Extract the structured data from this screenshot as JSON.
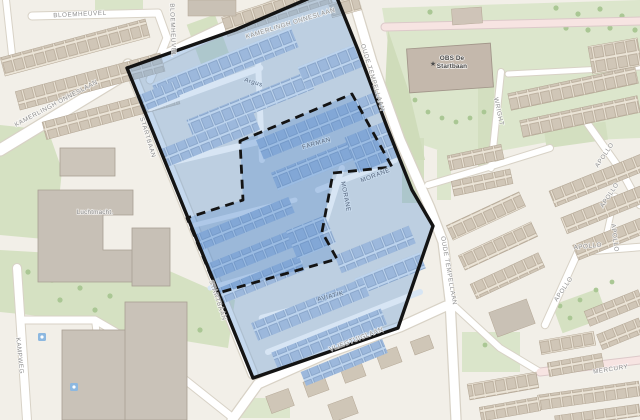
{
  "map": {
    "street_labels": [
      {
        "text": "BLOEMHEUVEL"
      },
      {
        "text": "BLOEMHEUVEL"
      },
      {
        "text": "KAMERLINGH ONNESLAAN"
      },
      {
        "text": "KAMERLINGH ONNESLAAN"
      },
      {
        "text": "OUDE TEMPELLAAN"
      },
      {
        "text": "OUDE TEMPELLAAN"
      },
      {
        "text": "STARTBAAN"
      },
      {
        "text": "STARTBAAN"
      },
      {
        "text": "VLIEGTUIGLAAN"
      },
      {
        "text": "KAMPWEG"
      },
      {
        "text": "WRIGHT"
      },
      {
        "text": "APOLLO"
      },
      {
        "text": "APOLLO"
      },
      {
        "text": "APOLLO"
      },
      {
        "text": "APOLLO"
      },
      {
        "text": "APOLLO"
      },
      {
        "text": "MERCURY"
      },
      {
        "text": "FARMAN"
      },
      {
        "text": "MORANE"
      },
      {
        "text": "MORANE"
      },
      {
        "text": "AVIATIK"
      },
      {
        "text": "Argus"
      }
    ],
    "poi": {
      "school_line1": "OBS De",
      "school_line2": "Startbaan",
      "building_label": "Luchtmacht."
    },
    "overlay": {
      "outer_fill": "#7da9dc",
      "inner_fill": "#3a78c4",
      "border_color": "#141414",
      "border_style_outer": "solid",
      "border_style_inner": "dashed"
    },
    "icon_names": [
      "school-icon",
      "poi-marker-icon",
      "poi-marker-icon"
    ],
    "base_colors": {
      "background": "#f2efe8",
      "green": "#d9e4c8",
      "road": "#ffffff",
      "road_pink": "#f7e4e2",
      "building": "#cfc6b7"
    }
  }
}
